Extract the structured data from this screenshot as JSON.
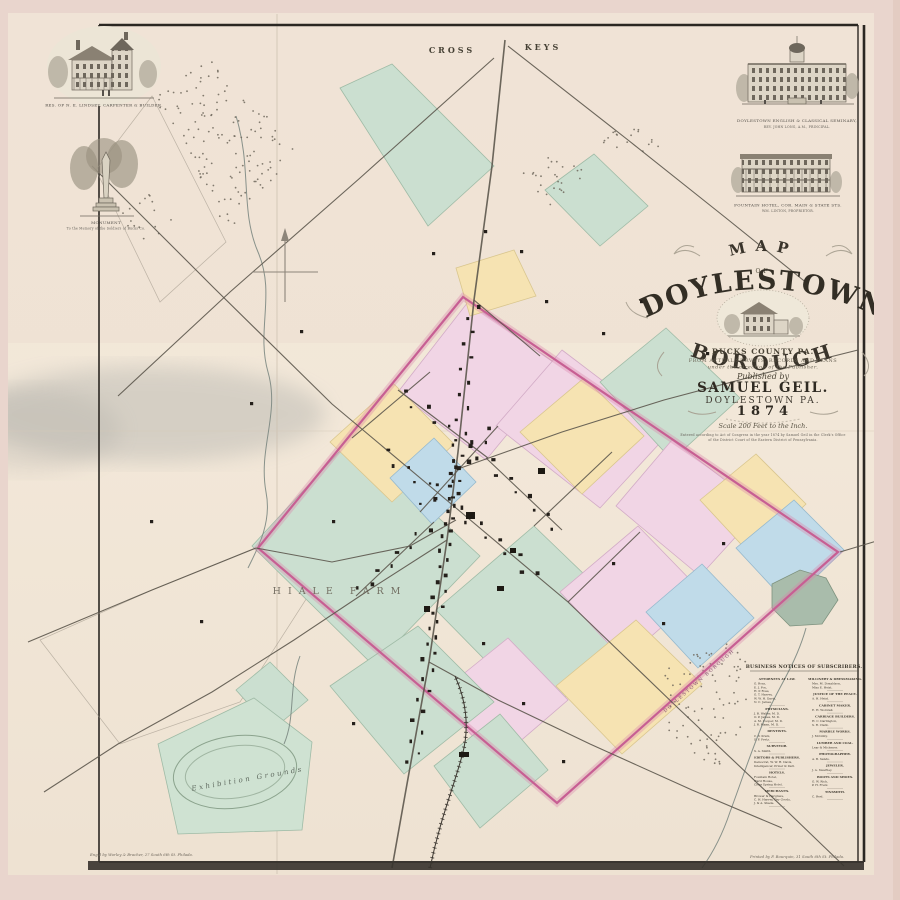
{
  "title_block": {
    "map_word": "MAP",
    "of_word": "OF",
    "town": "DOYLESTOWN",
    "borough": "BOROUGH",
    "county": "BUCKS COUNTY PA.",
    "surveys1": "FROM ACTUAL SURVEYS, RECORDS AND PLANS",
    "surveys2": "under the direction of the Publisher.",
    "published_by": "Published by",
    "publisher": "SAMUEL GEIL.",
    "place": "DOYLESTOWN PA.",
    "year": "1874",
    "scale_text": "Scale 200 Feet to the Inch.",
    "entry1": "Entered according to Act of Congress in the year 1874 by Samuel Geil in the Clerk's Office",
    "entry2": "of the District Court of the Eastern District of Pennsylvania."
  },
  "engravings": [
    {
      "id": "residence",
      "caption1": "RES. OF N. E. LINDSEY,  CARPENTER & BUILDER."
    },
    {
      "id": "monument",
      "caption1": "MONUMENT",
      "caption2": "To the Memory of the Soldiers of Bucks Co."
    },
    {
      "id": "seminary",
      "caption1": "DOYLESTOWN ENGLISH & CLASSICAL SEMINARY,",
      "caption2": "REV. JOHN LONG, A.M., PRINCIPAL."
    },
    {
      "id": "hotel",
      "caption1": "FOUNTAIN HOTEL, COR. MAIN & STATE STS.",
      "caption2": "WM. LINTON, PROPRIETOR."
    }
  ],
  "map_labels": {
    "cross": "CROSS",
    "keys": "KEYS",
    "farm": "HIALE FARM",
    "exhibition": "Exhibition Grounds",
    "borough_edge": "DOYLESTOWN BOROUGH"
  },
  "imprints": {
    "engraver": "Eng'd by Worley & Bracher, 27 South 6th St. Philada.",
    "printer": "Printed by F. Bourquin, 31 South 6th St. Philada."
  },
  "business_notices": {
    "header": "BUSINESS NOTICES OF SUBSCRIBERS.",
    "columns": [
      {
        "sections": [
          {
            "t": "ATTORNEYS AT LAW.",
            "e": [
              "G. Ross,",
              "E. J. Fox,",
              "H. P. Ross,",
              "G. T. Harvey,",
              "W. W. H. Davis,",
              "N. C. James."
            ]
          },
          {
            "t": "PHYSICIANS.",
            "e": [
              "J. B. Walter, M. D.",
              "O. P. James, M. D.",
              "A. M. Cooper, M. D.",
              "J. R. Mann, M. D."
            ]
          },
          {
            "t": "DENTISTS.",
            "e": [
              "C. V. Kratz,",
              "S. F. Fretz."
            ]
          },
          {
            "t": "SURVEYOR.",
            "e": [
              "S. A. Smith."
            ]
          },
          {
            "t": "EDITORS & PUBLISHERS.",
            "e": [
              "Democrat, W. W. H. Davis,",
              "Intelligencer, Prizer & Darl."
            ]
          },
          {
            "t": "HOTELS.",
            "e": [
              "Fountain Hotel,",
              "Ward House,",
              "Clear Spring Hotel."
            ]
          },
          {
            "t": "MERCHANTS.",
            "e": [
              "Brower & Hargrave,",
              "C. H. Harvey, Dry Goods,",
              "J. & A. Shade."
            ]
          }
        ]
      },
      {
        "sections": [
          {
            "t": "MILLINERY & DRESSMAKING.",
            "e": [
              "Mrs. M. Donaldson,",
              "Miss E. Heist."
            ]
          },
          {
            "t": "JUSTICE OF THE PEACE.",
            "e": [
              "A. H. Heist."
            ]
          },
          {
            "t": "CABINET MAKER.",
            "e": [
              "E. H. Worstall."
            ]
          },
          {
            "t": "CARRIAGE BUILDERS.",
            "e": [
              "H. C. Darlington,",
              "S. R. Clark."
            ]
          },
          {
            "t": "MARBLE WORKS.",
            "e": [
              "J. McGinty."
            ]
          },
          {
            "t": "LUMBER AND COAL.",
            "e": [
              "Lear & Michener."
            ]
          },
          {
            "t": "PHOTOGRAPHER.",
            "e": [
              "A. B. Sands."
            ]
          },
          {
            "t": "JEWELER.",
            "e": [
              "J. A. Swartley."
            ]
          },
          {
            "t": "BOOTS AND SHOES.",
            "e": [
              "G. W. Rich,",
              "P. H. Fretz."
            ]
          },
          {
            "t": "TINSMITH.",
            "e": [
              "C. Reel."
            ]
          }
        ]
      }
    ]
  },
  "map": {
    "colors": {
      "green": [
        "#cbdfd0",
        "#9fbba6"
      ],
      "greenex": [
        "#cfe2d2",
        "#9fbba6"
      ],
      "yellow": [
        "#f6e3b2",
        "#d9c68e"
      ],
      "pink": [
        "#f1d5e5",
        "#d2abc6"
      ],
      "blue": [
        "#c0dbe9",
        "#96b9cd"
      ],
      "pond": [
        "#a9bcab",
        "#7e927f"
      ]
    },
    "boundary": "463,297 838,552 557,803 258,548",
    "boundary_color": "#c75f93",
    "parcels": [
      {
        "c": "green",
        "p": "340,88 392,64 494,166 428,226"
      },
      {
        "c": "green",
        "p": "545,190 594,154 648,206 600,246"
      },
      {
        "c": "pink",
        "p": "468,302 562,368 486,460 398,392"
      },
      {
        "c": "pink",
        "p": "562,350 670,432 600,508 496,426"
      },
      {
        "c": "green",
        "p": "600,382 666,328 740,398 672,460"
      },
      {
        "c": "pink",
        "p": "672,440 762,508 700,576 616,506"
      },
      {
        "c": "yellow",
        "p": "700,500 756,454 806,504 752,556"
      },
      {
        "c": "blue",
        "p": "736,548 794,500 844,550 788,604"
      },
      {
        "c": "green",
        "p": "252,546 352,438 480,556 374,666"
      },
      {
        "c": "yellow",
        "p": "330,442 394,384 454,444 392,502"
      },
      {
        "c": "blue",
        "p": "390,478 434,438 476,482 432,524"
      },
      {
        "c": "yellow",
        "p": "520,432 584,378 644,436 582,494"
      },
      {
        "c": "green",
        "p": "436,610 534,526 640,628 542,718"
      },
      {
        "c": "pink",
        "p": "560,592 638,526 702,592 624,660"
      },
      {
        "c": "blue",
        "p": "646,612 702,564 754,618 698,668"
      },
      {
        "c": "yellow",
        "p": "556,686 636,620 702,684 622,754"
      },
      {
        "c": "pink",
        "p": "436,696 508,638 568,700 496,762"
      },
      {
        "c": "green",
        "p": "330,686 418,626 494,702 404,774"
      },
      {
        "c": "green",
        "p": "434,766 500,714 548,770 480,828"
      },
      {
        "c": "green",
        "p": "236,690 270,662 308,700 272,730"
      },
      {
        "c": "yellow",
        "p": "456,268 514,250 536,296 470,316"
      },
      {
        "c": "greenex",
        "p": "158,744 254,698 312,742 302,830 178,834"
      },
      {
        "c": "pond",
        "p": "772,584 800,570 826,578 838,600 822,624 790,626 772,608"
      }
    ],
    "streets": [
      "505,40 492,166 474,300 458,452 447,540 429,662 407,784 392,868",
      "92,166 214,288 332,404 456,508",
      "456,508 568,602 678,708 790,814 844,866",
      "508,46 628,140 726,218 808,284",
      "494,58 360,178 230,292 118,396",
      "28,642 152,590 256,548",
      "256,548 332,562 410,546 456,520",
      "840,552 880,540",
      "455,470 562,432 664,400 762,374 858,350",
      "447,540 372,588 294,640 212,692 118,744 44,792",
      "429,662 498,700 590,744 692,790 782,828",
      "398,390 488,458",
      "356,596 434,522",
      "420,512 498,426",
      "486,458 562,530",
      "352,438 430,372",
      "534,526 612,452",
      "568,602 640,532",
      "474,300 540,356"
    ],
    "creeks": [
      "M236,116 C252,168 240,210 258,252 C276,294 256,330 268,372 C280,414 258,448 266,492 C272,522 258,548 248,568",
      "M806,628 C796,664 778,688 766,716 C752,748 742,780 730,812 C722,836 712,854 702,868",
      "M300,656 C288,688 296,716 284,744"
    ],
    "railroad": "M430,868 C440,820 452,792 462,756 C470,728 466,700 455,676",
    "stipples": [
      {
        "p": "152,96 214,58 296,148 226,242",
        "n": 130
      },
      {
        "p": "518,168 558,144 588,176 548,208",
        "n": 26
      },
      {
        "p": "664,660 740,640 756,700 718,770 668,734",
        "n": 85
      },
      {
        "p": "598,136 638,114 666,146 628,172",
        "n": 18
      },
      {
        "p": "118,214 150,192 176,222 142,250",
        "n": 16
      }
    ],
    "field_outlines": [
      "96,170 152,96 226,242 160,302",
      "40,640 152,590 256,548 312,590 240,702 120,744"
    ],
    "building_rows": [
      {
        "s": "473,300 458,452",
        "n": 12
      },
      {
        "s": "458,452 447,540",
        "n": 14
      },
      {
        "s": "447,540 428,664",
        "n": 16
      },
      {
        "s": "428,664 410,768",
        "n": 10
      },
      {
        "s": "398,390 486,458",
        "n": 8
      },
      {
        "s": "356,596 432,522",
        "n": 8
      },
      {
        "s": "420,512 496,426",
        "n": 9
      },
      {
        "s": "486,458 560,530",
        "n": 8
      },
      {
        "s": "380,450 455,506",
        "n": 7
      },
      {
        "s": "455,506 540,580",
        "n": 9
      }
    ],
    "farm_houses": [
      [
        520,
        250
      ],
      [
        545,
        300
      ],
      [
        602,
        332
      ],
      [
        300,
        330
      ],
      [
        250,
        402
      ],
      [
        332,
        520
      ],
      [
        612,
        562
      ],
      [
        662,
        622
      ],
      [
        722,
        542
      ],
      [
        562,
        760
      ],
      [
        352,
        722
      ],
      [
        482,
        642
      ],
      [
        522,
        702
      ],
      [
        432,
        252
      ],
      [
        484,
        230
      ],
      [
        640,
        300
      ],
      [
        706,
        352
      ],
      [
        150,
        520
      ],
      [
        200,
        620
      ]
    ],
    "blocks": [
      [
        466,
        512,
        9,
        7
      ],
      [
        538,
        468,
        7,
        6
      ],
      [
        459,
        752,
        10,
        5
      ],
      [
        497,
        586,
        7,
        5
      ],
      [
        424,
        606,
        6,
        6
      ],
      [
        510,
        548,
        6,
        5
      ]
    ]
  }
}
